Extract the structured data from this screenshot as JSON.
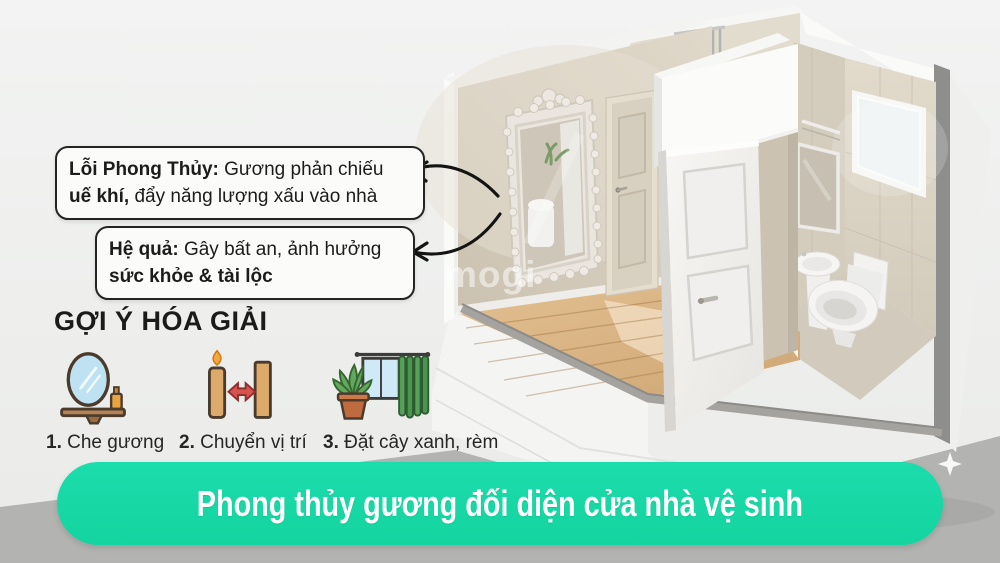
{
  "callouts": [
    {
      "bold1": "Lỗi Phong Thủy:",
      "text1": " Gương phản chiếu",
      "bold2": "uế khí,",
      "text2": " đẩy năng lượng xấu vào nhà"
    },
    {
      "bold1": "Hệ quả:",
      "text1": " Gây bất an, ảnh hưởng",
      "bold2": "sức khỏe & tài lộc",
      "text2": ""
    }
  ],
  "remedies": {
    "title": "GỢI Ý HÓA GIẢI",
    "items": [
      {
        "num": "1.",
        "label": " Che gương",
        "icon": "mirror-shelf-icon"
      },
      {
        "num": "2.",
        "label": " Chuyển vị trí",
        "icon": "candle-move-icon"
      },
      {
        "num": "3.",
        "label": " Đặt cây xanh, rèm",
        "icon": "plant-curtain-icon"
      }
    ]
  },
  "banner": {
    "text": "Phong thủy gương đối diện cửa nhà vệ sinh",
    "bg_color": "#17d9a6",
    "text_color": "#ffffff"
  },
  "watermark": {
    "text": "mogi"
  },
  "illustration": {
    "description": "isometric cutaway 3d render of bathroom with ornate mirror facing toilet door",
    "colors": {
      "wall_beige": "#d5ccbd",
      "tile_beige": "#ddd5c6",
      "wood_floor": "#dab687",
      "plinth_white": "#f4f4f2",
      "studio_floor_gray": "#b3b3b1",
      "cut_edge_gray": "#8e8e8c",
      "arrow_black": "#141412"
    }
  }
}
